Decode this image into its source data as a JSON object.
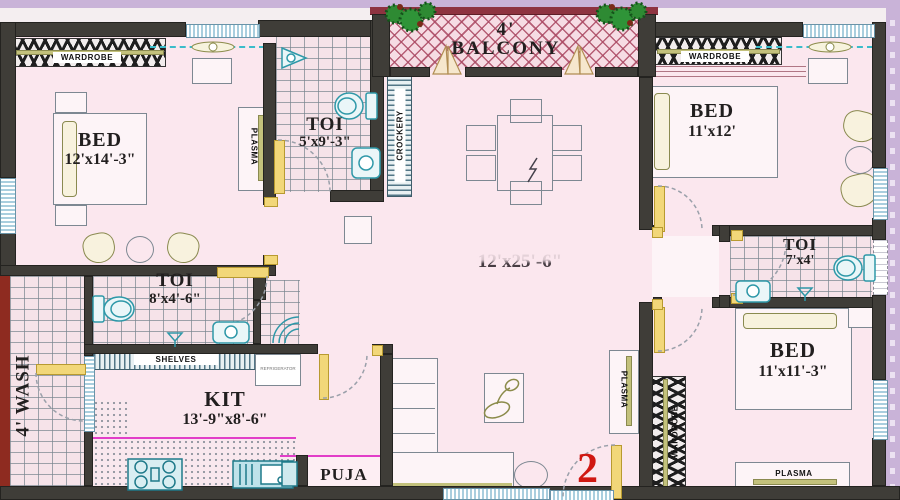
{
  "plan": {
    "unit_number": "2",
    "rooms": {
      "bed1": {
        "name": "BED",
        "dims": "12'x14'-3\""
      },
      "bed2": {
        "name": "BED",
        "dims": "11'x12'"
      },
      "bed3": {
        "name": "BED",
        "dims": "11'x11'-3\""
      },
      "toi1": {
        "name": "TOI",
        "dims": "5'x9'-3\""
      },
      "toi2": {
        "name": "TOI",
        "dims": "8'x4'-6\""
      },
      "toi3": {
        "name": "TOI",
        "dims": "7'x4'"
      },
      "kitchen": {
        "name": "KIT",
        "dims": "13'-9\"x8'-6\""
      },
      "living": {
        "dims": "12'x25'-6\""
      },
      "balcony": {
        "name": "4' BALCONY"
      },
      "wash": {
        "name": "4' WASH"
      },
      "puja": {
        "name": "PUJA"
      }
    },
    "fixtures": {
      "wardrobe": "WARDROBE",
      "plasma": "PLASMA",
      "shelves": "SHELVES",
      "crockery": "CROCKERY",
      "refrigerator": "REFRIGERATOR"
    },
    "colors": {
      "lavender": "#c9b3d8",
      "planBg": "#fbe7ee",
      "wall": "#3f3d38",
      "wallDark": "#242320",
      "redwall": "#8e2b20",
      "maroon": "#8e3340",
      "yellow": "#f2d779",
      "teal": "#2e98a8",
      "khaki": "#c3c17c",
      "khakiDark": "#8a8a50",
      "grayline": "#7d8892",
      "magenta": "#e23ec8",
      "cyan": "#3bbcca",
      "windowBlue": "#a9cede",
      "red2": "#d01812",
      "text": "#221f1f"
    }
  }
}
